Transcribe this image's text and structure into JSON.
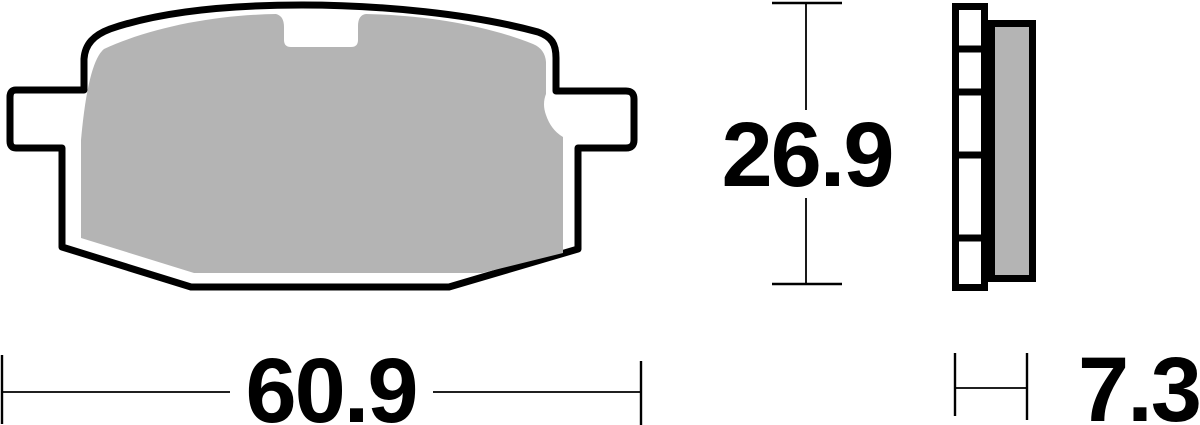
{
  "dimensions": {
    "width": {
      "value": "60.9"
    },
    "height": {
      "value": "26.9"
    },
    "thickness": {
      "value": "7.3"
    }
  },
  "colors": {
    "outline": "#000000",
    "friction_material": "#b4b4b4",
    "backing_plate_fill": "#ffffff",
    "dimension_lines": "#000000",
    "background": "#ffffff"
  }
}
